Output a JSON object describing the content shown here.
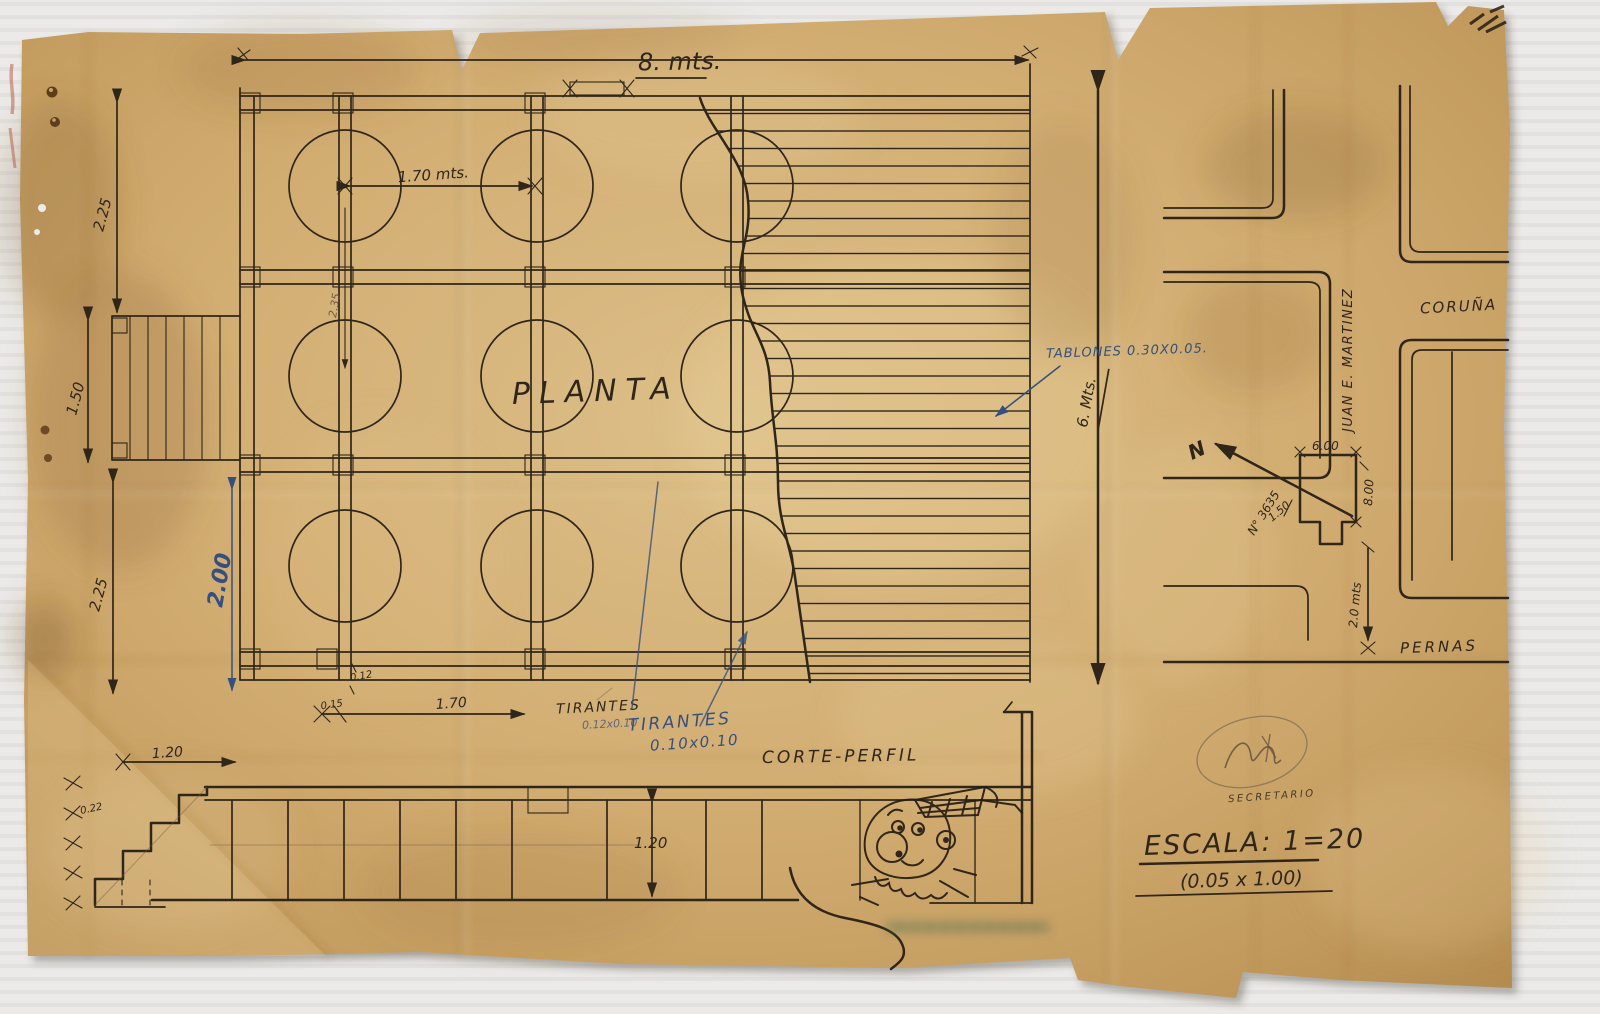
{
  "colors": {
    "background": "#eceae8",
    "paper": "#cfa76b",
    "ink": "#2f2619",
    "blue_ink": "#35507e",
    "pencil": "#6e5c44",
    "stamp_red": "#b57d5e",
    "stamp_green": "#4a6b52"
  },
  "plan": {
    "title": "PLANTA",
    "dim_top_width": "8. mts.",
    "dim_pile_spacing": "1.70 mts.",
    "dim_left_top": "2.25",
    "dim_left_mid": "1.50",
    "dim_left_bottom": "2.25",
    "dim_depth_blue": "2.00",
    "dim_inner": "2.35",
    "dim_right_height": "6. Mts.",
    "dim_beam_width": "0.12",
    "dim_edge_offset": "0.15",
    "dim_bottom_spacing": "1.70",
    "note_tablones": "TABLONES 0.30X0.05.",
    "note_tirantes_pencil_label": "TIRANTES",
    "note_tirantes_pencil_size": "0.12x0.10",
    "note_tirantes_blue_label": "TIRANTES",
    "note_tirantes_blue_size": "0.10x0.10"
  },
  "section": {
    "title": "CORTE-PERFIL",
    "dim_height": "1.20",
    "dim_stair_run": "1.20",
    "dim_stair_rise": "0.22"
  },
  "site_map": {
    "street_coruna": "CORUÑA",
    "street_juan_e_martinez": "JUAN E. MARTINEZ",
    "street_pernas": "PERNAS",
    "north_letter": "N",
    "plot_number": "N° 3635",
    "dim_frontage": "6.00",
    "dim_depth": "8.00",
    "dim_side": "1.50",
    "dim_distance": "2.0 mts"
  },
  "title_block": {
    "scale": "ESCALA: 1=20",
    "scale_detail": "(0.05 x 1.00)",
    "stamp_text": "SECRETARIO"
  }
}
